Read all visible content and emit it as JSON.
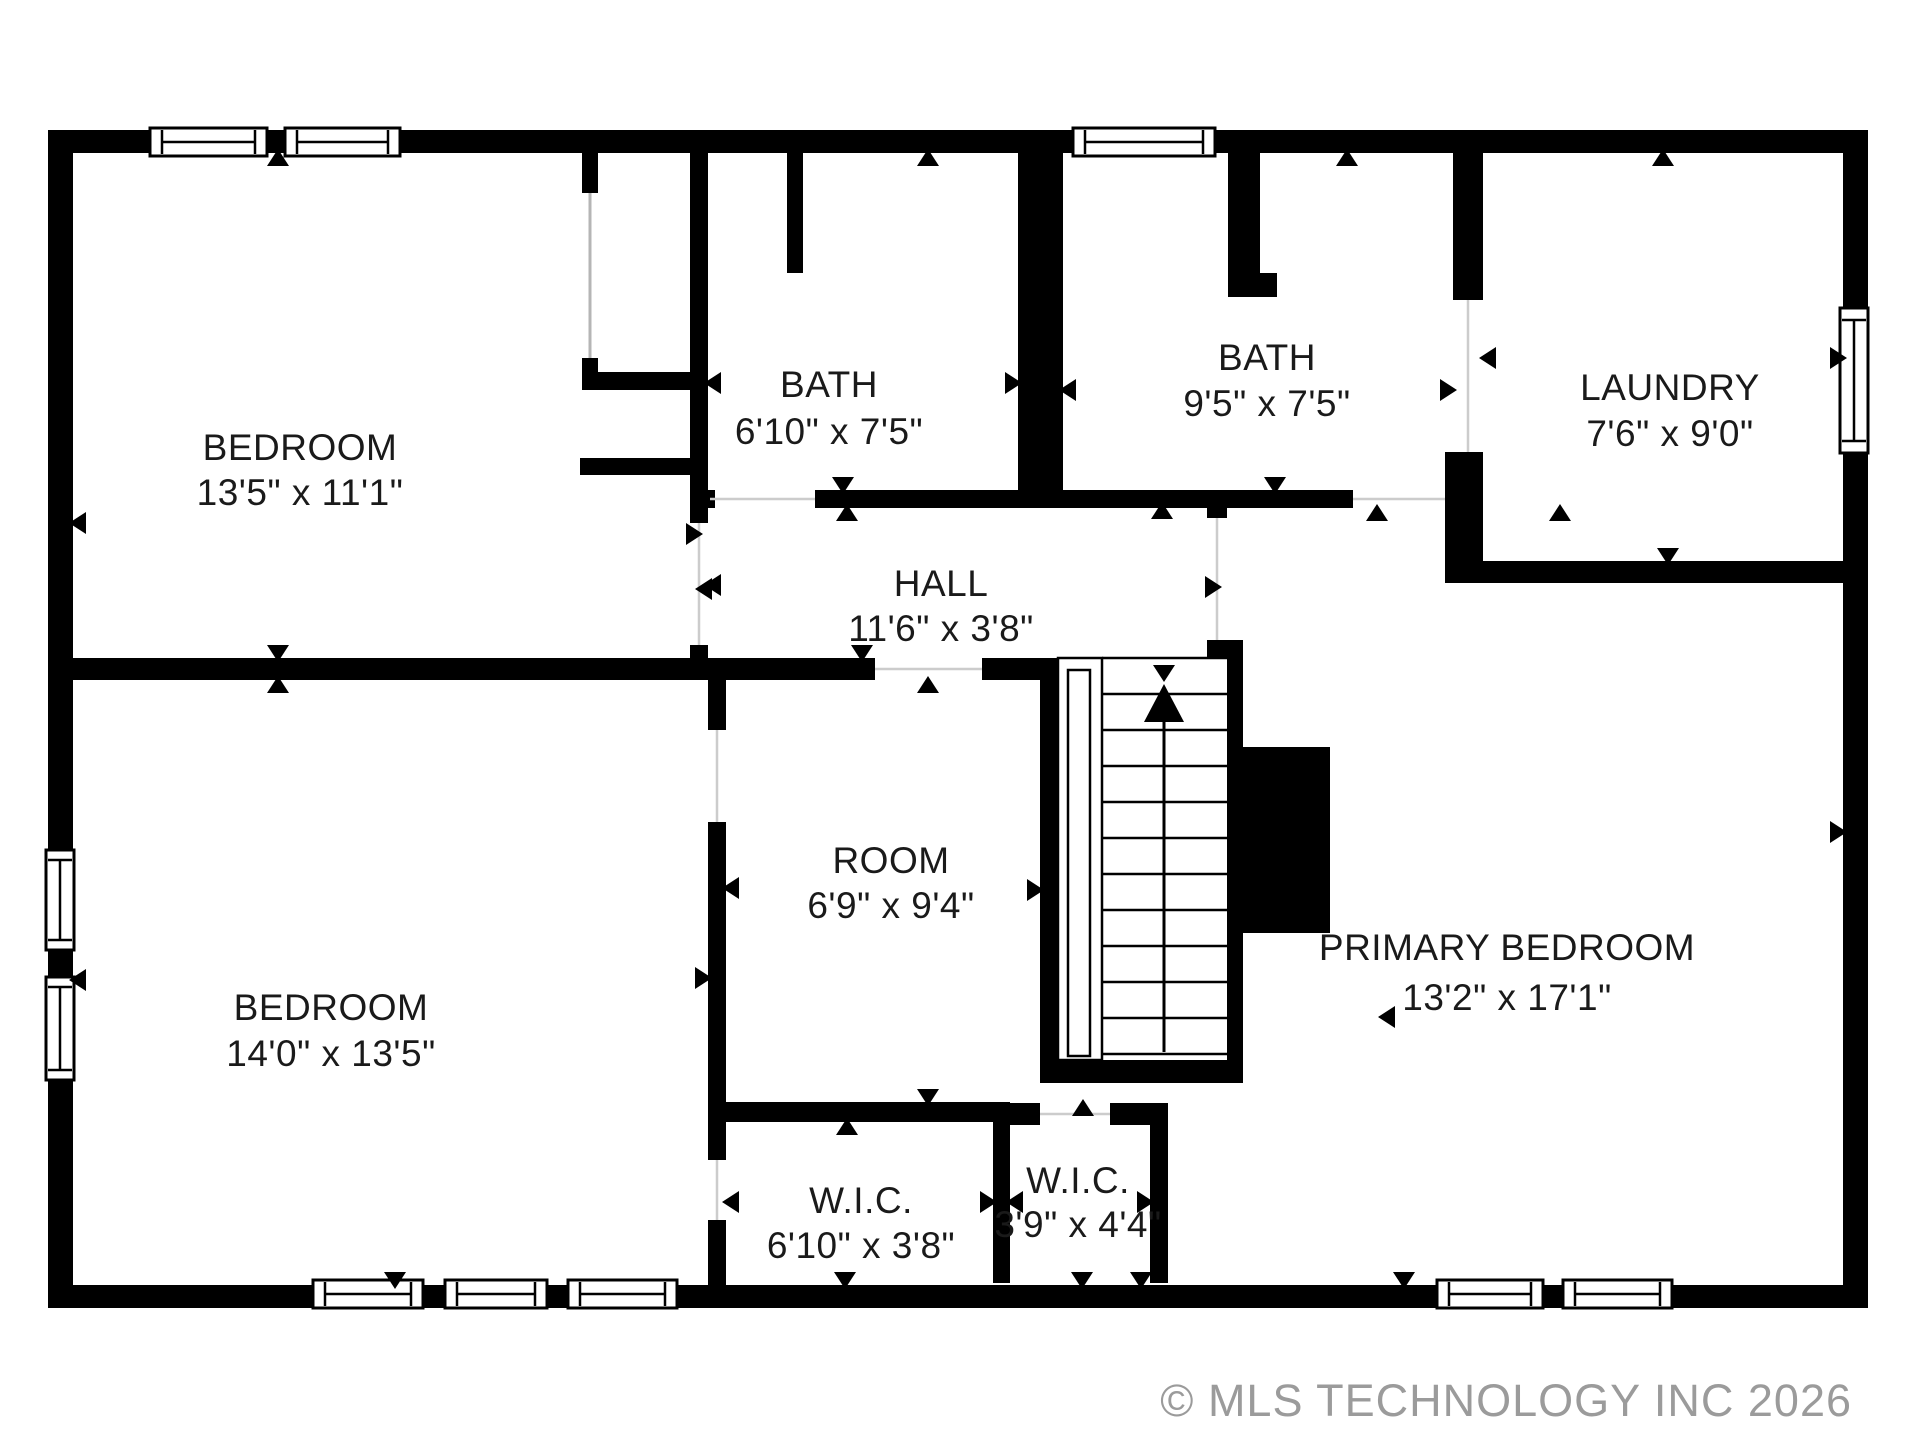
{
  "rooms": {
    "bedroom1": {
      "name": "BEDROOM",
      "dims": "13'5\" x 11'1\""
    },
    "bath1": {
      "name": "BATH",
      "dims": "6'10\" x 7'5\""
    },
    "bath2": {
      "name": "BATH",
      "dims": "9'5\" x 7'5\""
    },
    "laundry": {
      "name": "LAUNDRY",
      "dims": "7'6\" x 9'0\""
    },
    "hall": {
      "name": "HALL",
      "dims": "11'6\" x 3'8\""
    },
    "bedroom2": {
      "name": "BEDROOM",
      "dims": "14'0\" x 13'5\""
    },
    "room": {
      "name": "ROOM",
      "dims": "6'9\" x 9'4\""
    },
    "primary": {
      "name": "PRIMARY BEDROOM",
      "dims": "13'2\" x 17'1\""
    },
    "wic1": {
      "name": "W.I.C.",
      "dims": "6'10\" x 3'8\""
    },
    "wic2": {
      "name": "W.I.C.",
      "dims": "3'9\" x 4'4\""
    }
  },
  "watermark": {
    "text": "© MLS TECHNOLOGY INC 2026"
  },
  "colors": {
    "wall": "#000000",
    "background": "#ffffff",
    "label": "#1a1a1a",
    "watermark": "#9b9b9b",
    "door_opening": "#cccccc"
  }
}
